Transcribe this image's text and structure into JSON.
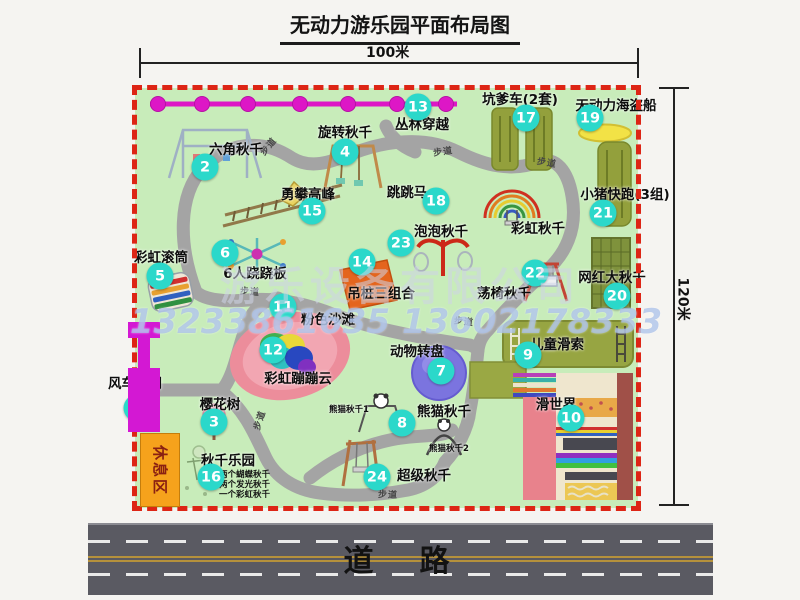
{
  "title": "无动力游乐园平面布局图",
  "dimension_top": "100米",
  "dimension_right": "120米",
  "road_label": "道　路",
  "rest_area_label": "休息区",
  "walkway_label": "步道",
  "watermark": {
    "company": "游乐设备有限公司",
    "phone": "13233861635 13602178333"
  },
  "colors": {
    "park_green": "#c8ecba",
    "border_red": "#dd2515",
    "marker_teal": "#2bd8ca",
    "path_gray": "#a4a4a4",
    "zipline_magenta": "#dd17c6",
    "gate_magenta": "#d318d3",
    "rest_orange": "#f6a21c",
    "road_gray": "#5a5a62"
  },
  "walkways": [
    {
      "x": 133,
      "y": 58,
      "r": -50
    },
    {
      "x": 308,
      "y": 63,
      "r": -8
    },
    {
      "x": 412,
      "y": 74,
      "r": 10
    },
    {
      "x": 115,
      "y": 203,
      "r": 4
    },
    {
      "x": 124,
      "y": 332,
      "r": -72
    },
    {
      "x": 329,
      "y": 233,
      "r": 6
    },
    {
      "x": 253,
      "y": 406,
      "r": 2
    }
  ],
  "markers": [
    {
      "num": "1",
      "label": "风车大门",
      "cx": 2,
      "cy": 320,
      "lx": 0,
      "ly": 294
    },
    {
      "num": "2",
      "label": "六角秋千",
      "cx": 70,
      "cy": 79,
      "lx": 101,
      "ly": 60
    },
    {
      "num": "3",
      "label": "樱花树",
      "cx": 79,
      "cy": 334,
      "lx": 85,
      "ly": 315
    },
    {
      "num": "4",
      "label": "旋转秋千",
      "cx": 210,
      "cy": 64,
      "lx": 210,
      "ly": 43
    },
    {
      "num": "5",
      "label": "彩虹滚筒",
      "cx": 25,
      "cy": 188,
      "lx": 26,
      "ly": 168
    },
    {
      "num": "6",
      "label": "6人跷跷板",
      "cx": 90,
      "cy": 165,
      "lx": 120,
      "ly": 184
    },
    {
      "num": "7",
      "label": "动物转盘",
      "cx": 306,
      "cy": 283,
      "lx": 282,
      "ly": 262
    },
    {
      "num": "8",
      "label": "熊猫秋千",
      "cx": 267,
      "cy": 335,
      "lx": 309,
      "ly": 322
    },
    {
      "num": "9",
      "label": "儿童滑索",
      "cx": 393,
      "cy": 267,
      "lx": 422,
      "ly": 255
    },
    {
      "num": "10",
      "label": "滑世界",
      "cx": 436,
      "cy": 330,
      "lx": 421,
      "ly": 315
    },
    {
      "num": "11",
      "label": "粉色沙滩",
      "cx": 148,
      "cy": 219,
      "lx": 193,
      "ly": 230
    },
    {
      "num": "12",
      "label": "彩虹蹦蹦云",
      "cx": 138,
      "cy": 262,
      "lx": 163,
      "ly": 289
    },
    {
      "num": "13",
      "label": "丛林穿越",
      "cx": 283,
      "cy": 19,
      "lx": 287,
      "ly": 35
    },
    {
      "num": "14",
      "label": "吊桩三组合",
      "cx": 227,
      "cy": 174,
      "lx": 246,
      "ly": 204
    },
    {
      "num": "15",
      "label": "勇攀高峰",
      "cx": 177,
      "cy": 123,
      "lx": 173,
      "ly": 105
    },
    {
      "num": "16",
      "label": "秋千乐园",
      "cx": 76,
      "cy": 389,
      "lx": 93,
      "ly": 371,
      "sx": 84,
      "sy": 382,
      "sub": [
        "两个蝴蝶秋千",
        "两个发光秋千",
        "一个彩虹秋千"
      ]
    },
    {
      "num": "17",
      "label": "坑爹车(2套)",
      "cx": 391,
      "cy": 30,
      "lx": 385,
      "ly": 10
    },
    {
      "num": "18",
      "label": "跳跳马",
      "cx": 301,
      "cy": 113,
      "lx": 272,
      "ly": 103
    },
    {
      "num": "19",
      "label": "无动力海盗船",
      "cx": 455,
      "cy": 30,
      "lx": 481,
      "ly": 16
    },
    {
      "num": "20",
      "label": "网红大秋千",
      "cx": 482,
      "cy": 208,
      "lx": 477,
      "ly": 188
    },
    {
      "num": "21",
      "label": "小猪快跑(3组)",
      "cx": 468,
      "cy": 125,
      "lx": 490,
      "ly": 105
    },
    {
      "num": "22",
      "label": "荡椅秋千",
      "cx": 400,
      "cy": 185,
      "lx": 369,
      "ly": 204
    },
    {
      "num": "23",
      "label": "泡泡秋千",
      "cx": 266,
      "cy": 155,
      "lx": 306,
      "ly": 142
    },
    {
      "num": "24",
      "label": "超级秋千",
      "cx": 242,
      "cy": 389,
      "lx": 289,
      "ly": 386
    }
  ],
  "extra_labels": [
    {
      "text": "彩虹秋千",
      "x": 403,
      "y": 139,
      "name": "rainbow-swing-label"
    },
    {
      "text": "熊猫秋千1",
      "x": 214,
      "y": 321,
      "fs": 8.5,
      "name": "panda-swing-1-label"
    },
    {
      "text": "熊猫秋千2",
      "x": 314,
      "y": 360,
      "fs": 8.5,
      "name": "panda-swing-2-label"
    }
  ]
}
